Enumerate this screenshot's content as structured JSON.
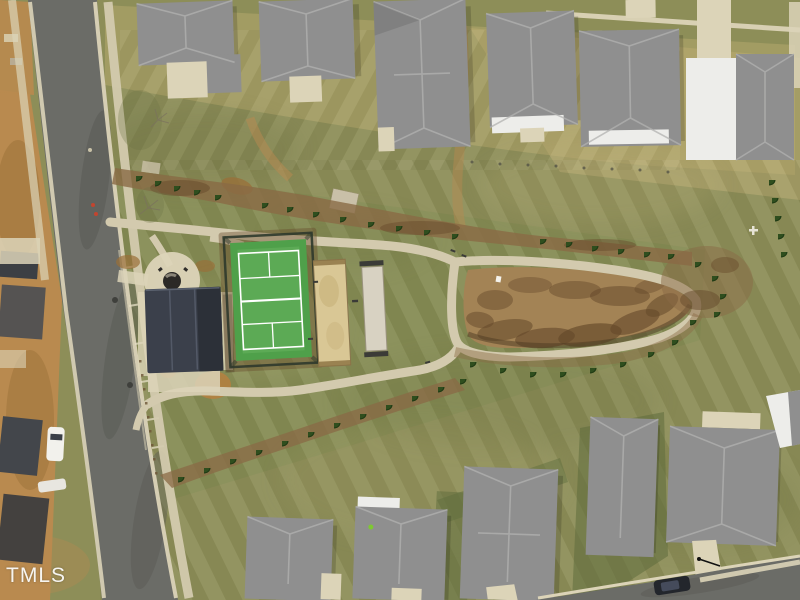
{
  "watermark": {
    "text": "TMLS"
  },
  "palette": {
    "grass_base": "#8D8E58",
    "grass_park": "#828A52",
    "grass_dark": "#5E6C3C",
    "yard_straw": "#BCAC72",
    "dirt": "#B98A4F",
    "dirt_dark": "#9A6F38",
    "road": "#6B6C67",
    "road_dark": "#575853",
    "concrete": "#DCD4B8",
    "path": "#D3CAAE",
    "roof_gray": "#8F8F8F",
    "roof_light": "#B2B2B0",
    "roof_dark": "#6A6A68",
    "roof_white": "#EDEDEA",
    "pavilion_roof": "#3B404B",
    "court_green": "#4FA04A",
    "court_green_light": "#7CC36F",
    "court_line": "#FFFFFF",
    "fence_dark": "#2F3A2C",
    "sand": "#D9C795",
    "sand_light": "#D8D2C2",
    "mulch": "#8A6A45",
    "mulch_dark": "#66492B",
    "shrub": "#2F4E1E",
    "meadow": "#A38355",
    "meadow_dark": "#64482A",
    "bench_dark": "#3B3B37",
    "truck_white": "#F2F1EC",
    "car_dark": "#23262C",
    "marker_red": "#C2452F"
  }
}
